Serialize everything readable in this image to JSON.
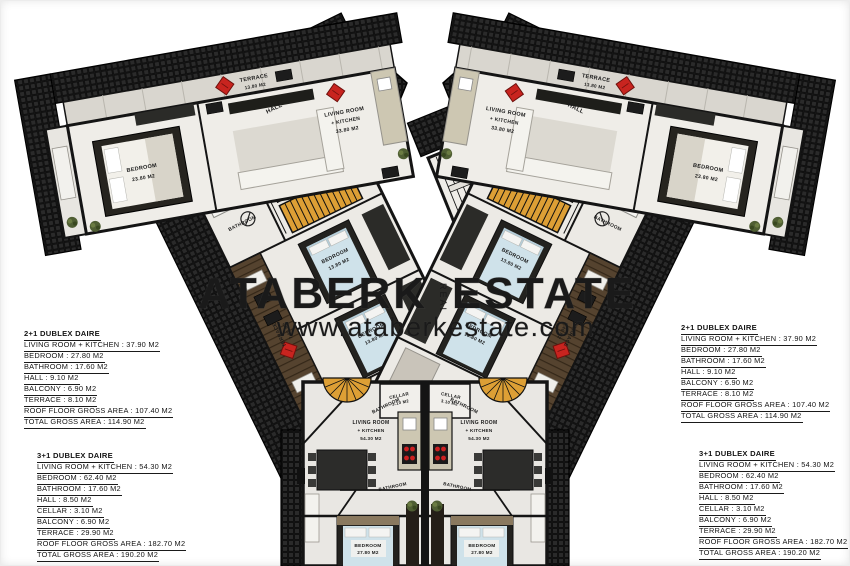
{
  "watermark": {
    "brand_left": "ATABERK",
    "brand_right": "ESTATE",
    "vertical": "REAL",
    "url": "www.ataberkestate.com"
  },
  "specs": {
    "duplex_2_1": {
      "title": "2+1 DUBLEX DAIRE",
      "lines": [
        "LIVING ROOM + KITCHEN : 37.90 M2",
        "BEDROOM : 27.80 M2",
        "BATHROOM : 17.60 M2",
        "HALL : 9.10 M2",
        "BALCONY : 6.90 M2",
        "TERRACE : 8.10 M2",
        "ROOF FLOOR GROSS AREA : 107.40 M2",
        "TOTAL GROSS AREA : 114.90 M2"
      ]
    },
    "duplex_3_1": {
      "title": "3+1 DUBLEX DAIRE",
      "lines": [
        "LIVING ROOM + KITCHEN : 54.30 M2",
        "BEDROOM : 62.40 M2",
        "BATHROOM : 17.60 M2",
        "HALL : 8.50 M2",
        "CELLAR : 3.10 M2",
        "BALCONY : 6.90 M2",
        "TERRACE : 29.90 M2",
        "ROOF FLOOR GROSS AREA : 182.70 M2",
        "TOTAL GROSS AREA : 190.20 M2"
      ]
    }
  },
  "plan_labels": {
    "terrace": "TERRACE",
    "terrace_area": "13.80 M2",
    "side_terrace": "TERRACE",
    "side_terrace_area": "7.40 M2",
    "living_room": "LIVING ROOM",
    "kitchen_suffix": "+ KITCHEN",
    "living_top_area": "33.80 M2",
    "bedroom": "BEDROOM",
    "bedroom_top_area": "23.80 M2",
    "bedroom_mid_area": "13.80 M2",
    "bedroom_bottom_area": "27.80 M2",
    "hall": "HALL",
    "bathroom": "BATHROOM",
    "cellar": "CELLAR",
    "cellar_area": "3.10 M2",
    "elevator": "ELEVATOR",
    "elevator_area": "4.30 M2",
    "living_bottom_area": "54.30 M2"
  },
  "colors": {
    "roof_dark": "#1b1b1b",
    "stair_yellow": "#dd9f35",
    "elevator_mauve": "#ab9193",
    "jacuzzi_blue": "#3f9fd4",
    "accent_red": "#c8241f",
    "bed_blue": "#cfe2ea",
    "plant_green": "#4f5e33"
  }
}
